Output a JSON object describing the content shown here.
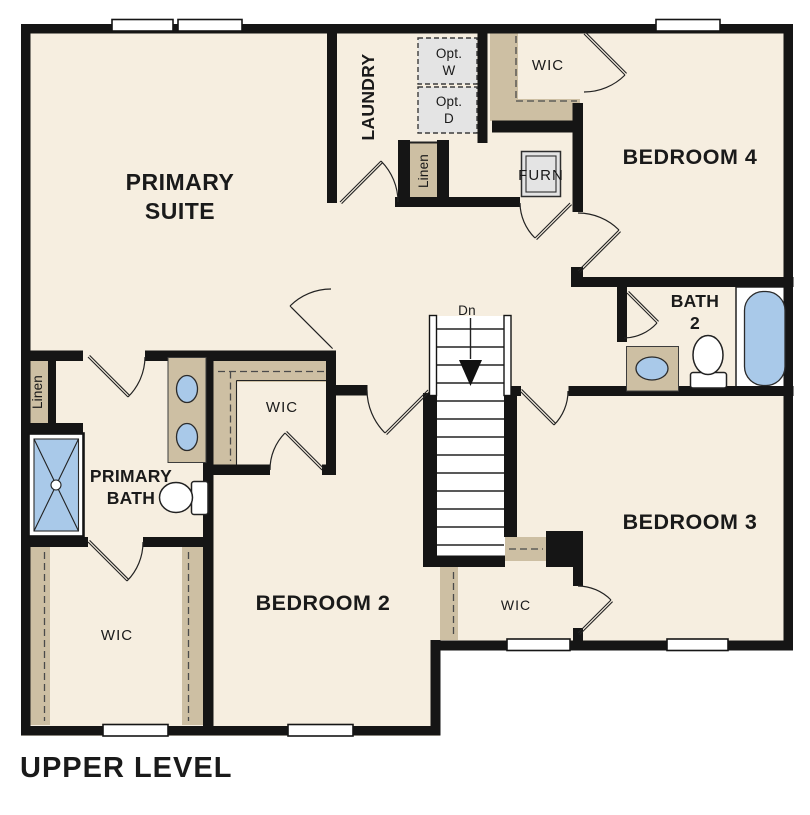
{
  "title": "UPPER LEVEL",
  "colors": {
    "floor": "#F6EEE0",
    "wall": "#151515",
    "shelf": "#CDBFA3",
    "fixture": "#A9C9E9",
    "appliance": "#E4E4E4",
    "text": "#1A1A1A"
  },
  "rooms": {
    "primary_suite": {
      "line1": "PRIMARY",
      "line2": "SUITE"
    },
    "laundry": {
      "label": "LAUNDRY"
    },
    "opt_washer": {
      "line1": "Opt.",
      "line2": "W"
    },
    "opt_dryer": {
      "line1": "Opt.",
      "line2": "D"
    },
    "wic_bedroom4": {
      "label": "WIC"
    },
    "bedroom4": {
      "label": "BEDROOM 4"
    },
    "furnace": {
      "label": "FURN"
    },
    "linen_hall": {
      "label": "Linen"
    },
    "bath2": {
      "line1": "BATH",
      "line2": "2"
    },
    "stairs": {
      "label": "Dn"
    },
    "linen_primary": {
      "label": "Linen"
    },
    "wic_primary_small": {
      "label": "WIC"
    },
    "primary_bath": {
      "line1": "PRIMARY",
      "line2": "BATH"
    },
    "wic_primary_large": {
      "label": "WIC"
    },
    "bedroom2": {
      "label": "BEDROOM 2"
    },
    "bedroom3": {
      "label": "BEDROOM 3"
    },
    "wic_understairs": {
      "label": "WIC"
    }
  }
}
